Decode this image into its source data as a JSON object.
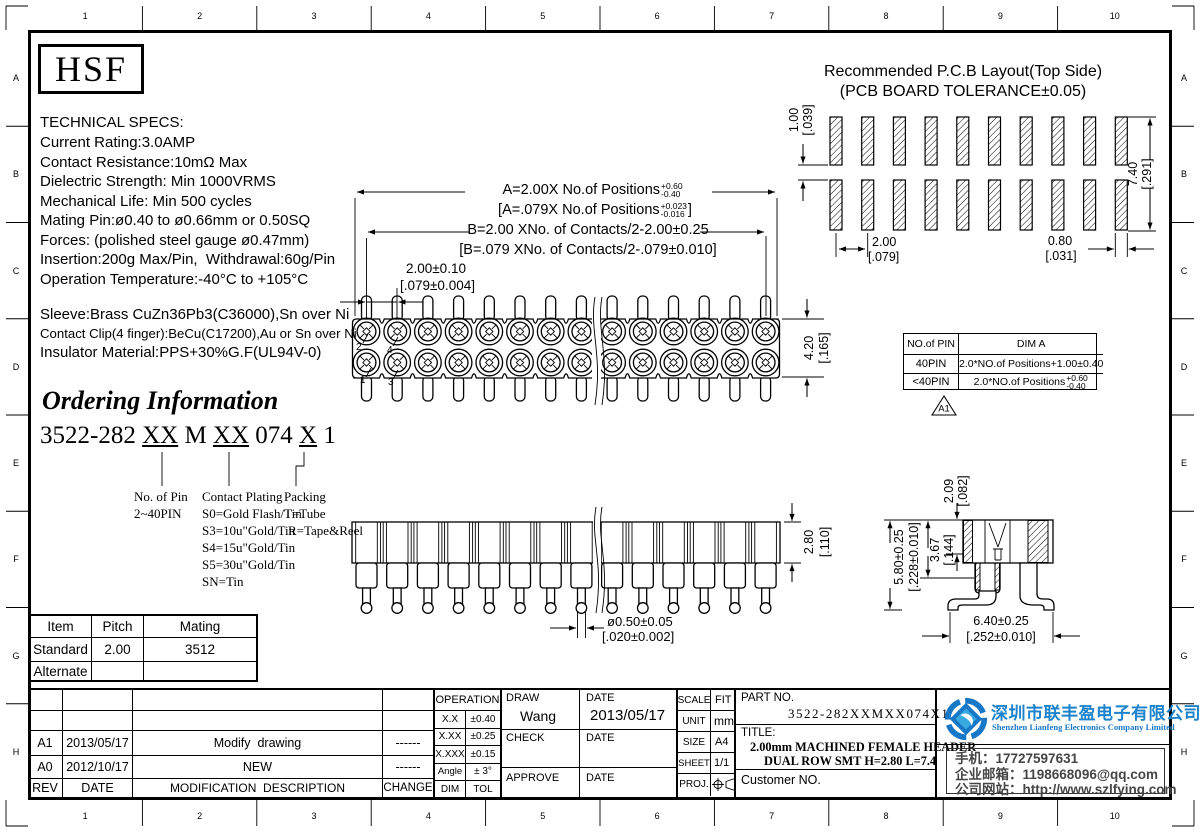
{
  "ruler": {
    "cols": [
      "1",
      "2",
      "3",
      "4",
      "5",
      "6",
      "7",
      "8",
      "9",
      "10"
    ],
    "rows": [
      "A",
      "B",
      "C",
      "D",
      "E",
      "F",
      "G",
      "H"
    ]
  },
  "logo_text": "HSF",
  "tech_specs": {
    "title": "TECHNICAL SPECS:",
    "lines": [
      "Current Rating:3.0AMP",
      "Contact Resistance:10mΩ Max",
      "Dielectric Strength: Min 1000VRMS",
      "Mechanical Life: Min 500 cycles",
      "Mating Pin:ø0.40 to ø0.66mm or 0.50SQ",
      "Forces: (polished steel gauge ø0.47mm)",
      "Insertion:200g Max/Pin,  Withdrawal:60g/Pin",
      "Operation Temperature:-40°C to +105°C"
    ]
  },
  "materials": {
    "line1": "Sleeve:Brass CuZn36Pb3(C36000),Sn over Ni",
    "line2": "Contact Clip(4 finger):BeCu(C17200),Au or Sn over Ni",
    "line3": "Insulator Material:PPS+30%G.F(UL94V-0)"
  },
  "ordering": {
    "title": "Ordering Information",
    "code_parts": [
      "3522-282 ",
      "XX",
      " M ",
      "XX",
      " 074 ",
      "X",
      " 1"
    ],
    "pin_label": "No. of Pin",
    "pin_range": "2~40PIN",
    "plating_label": "Contact Plating",
    "plating_options": [
      "S0=Gold Flash/Tin",
      "S3=10u\"Gold/Tin",
      "S4=15u\"Gold/Tin",
      "S5=30u\"Gold/Tin",
      "SN=Tin"
    ],
    "packing_label": "Packing",
    "packing_options": [
      "T=Tube",
      "R=Tape&Reel"
    ]
  },
  "dims": {
    "dim_a_mm": "A=2.00X No.of Positions",
    "dim_a_tol_top": "+0.60",
    "dim_a_tol_bot": "-0.40",
    "dim_a_in_open": "[A=.079X No.of Positions",
    "dim_a_in_tol_top": "+0.023",
    "dim_a_in_tol_bot": "-0.016",
    "bracket_close": "]",
    "dim_b_mm": "B=2.00 XNo. of Contacts/2-2.00±0.25",
    "dim_b_in": "[B=.079 XNo. of Contacts/2-.079±0.010]",
    "pitch_mm": "2.00±0.10",
    "pitch_in": "[.079±0.004]",
    "height_mm": "4.20",
    "height_in": "[.165]",
    "pin_no_1": "1",
    "pin_no_2": "2",
    "pin_no_3": "3",
    "pin_no_4": "4",
    "tail_mm": "ø0.50±0.05",
    "tail_in": "[.020±0.002]",
    "bodyh_mm": "2.80",
    "bodyh_in": "[.110]",
    "d209_mm": "2.09",
    "d209_in": "[.082]",
    "d367_mm": "3.67",
    "d367_in": "[.144]",
    "d580_mm": "5.80±0.25",
    "d580_in": "[.228±0.010]",
    "d640_mm": "6.40±0.25",
    "d640_in": "[.252±0.010]"
  },
  "pcb": {
    "title1": "Recommended P.C.B Layout(Top Side)",
    "title2": "(PCB BOARD TOLERANCE±0.05)",
    "gap_mm": "1.00",
    "gap_in": "[.039]",
    "span_mm": "7.40",
    "span_in": "[.291]",
    "pitch_mm": "2.00",
    "pitch_in": "[.079]",
    "pad_mm": "0.80",
    "pad_in": "[.031]"
  },
  "pin_table": {
    "col_pin": "NO.of PIN",
    "col_dim": "DIM A",
    "row1_pin": "40PIN",
    "row1_dim": "2.0*NO.of Positions+1.00±0.40",
    "row2_pin": "<40PIN",
    "row2_dim": "2.0*NO.of Positions",
    "row2_tol_top": "+0.60",
    "row2_tol_bot": "-0.40",
    "rev_flag": "A1"
  },
  "mating_table": {
    "headers": [
      "Item",
      "Pitch",
      "Mating"
    ],
    "rows": [
      [
        "Standard",
        "2.00",
        "3512"
      ],
      [
        "Alternate",
        "",
        ""
      ]
    ]
  },
  "revision_table": {
    "headers": {
      "rev": "REV",
      "date": "DATE",
      "desc": "MODIFICATION  DESCRIPTION",
      "change": "CHANGE"
    },
    "rows": [
      {
        "rev": "A1",
        "date": "2013/05/17",
        "desc": "Modify  drawing",
        "change": "------"
      },
      {
        "rev": "A0",
        "date": "2012/10/17",
        "desc": "NEW",
        "change": "------"
      }
    ]
  },
  "tolerance_table": {
    "title": "OPERATION",
    "rows": [
      [
        "X.X",
        "±0.40"
      ],
      [
        "X.XX",
        "±0.25"
      ],
      [
        "X.XXX",
        "±0.15"
      ],
      [
        "Angle",
        "± 3°"
      ],
      [
        "DIM",
        "TOL"
      ]
    ]
  },
  "approval": {
    "draw_label": "DRAW",
    "draw_name": "Wang",
    "date_label": "DATE",
    "draw_date": "2013/05/17",
    "check_label": "CHECK",
    "approve_label": "APPROVE"
  },
  "info": {
    "scale_label": "SCALE",
    "scale": "FIT",
    "unit_label": "UNIT",
    "unit": "mm",
    "size_label": "SIZE",
    "size": "A4",
    "sheet_label": "SHEET",
    "sheet": "1/1",
    "proj_label": "PROJ."
  },
  "part": {
    "part_no_label": "PART NO.",
    "part_no": "3522-282XXMXX074X1",
    "title_label": "TITLE:",
    "title_line1": "2.00mm MACHINED FEMALE HEADER",
    "title_line2": "DUAL ROW SMT H=2.80 L=7.4",
    "customer_label": "Customer NO."
  },
  "company": {
    "name_cn": "深圳市联丰盈电子有限公司",
    "name_en": "Shenzhen Lianfeng Electronics Company Limited",
    "phone": "手机：17727597631",
    "email": "企业邮箱：1198668096@qq.com",
    "website": "公司网站：http://www.szlfying.com",
    "brand_blue": "#1c82cc"
  }
}
